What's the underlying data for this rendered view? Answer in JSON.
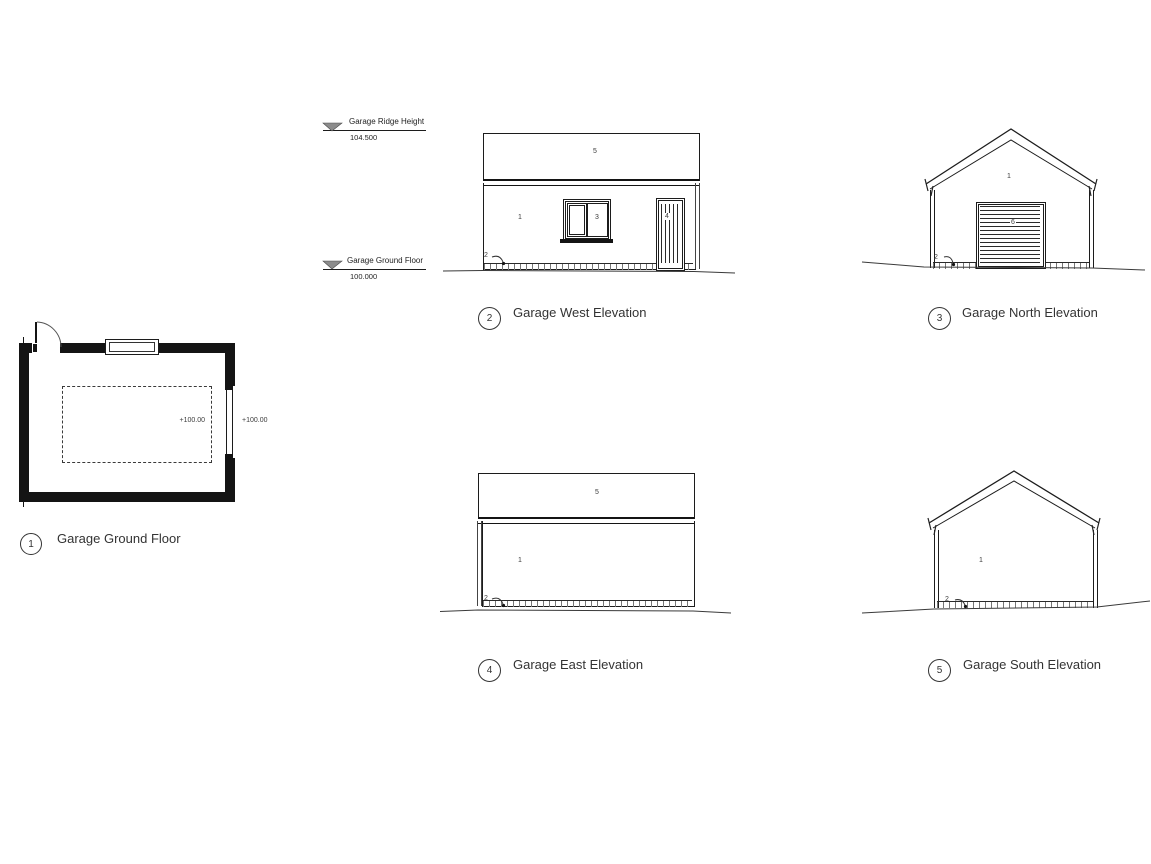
{
  "sheet": {
    "background": "#ffffff",
    "line_color": "#1c1c1c"
  },
  "levels": [
    {
      "label": "Garage Ridge Height",
      "value": "104.500"
    },
    {
      "label": "Garage Ground Floor",
      "value": "100.000"
    }
  ],
  "views": {
    "plan": {
      "number": "1",
      "title": "Garage Ground Floor",
      "level_inside": "+100.00",
      "level_outside": "+100.00"
    },
    "west": {
      "number": "2",
      "title": "Garage West Elevation",
      "tags": {
        "roof": "5",
        "wall": "1",
        "window": "3",
        "door": "4",
        "ground": "2"
      }
    },
    "north": {
      "number": "3",
      "title": "Garage North Elevation",
      "tags": {
        "wall": "1",
        "garage_door": "6",
        "ground": "2"
      }
    },
    "east": {
      "number": "4",
      "title": "Garage East Elevation",
      "tags": {
        "roof": "5",
        "wall": "1",
        "ground": "2"
      }
    },
    "south": {
      "number": "5",
      "title": "Garage South Elevation",
      "tags": {
        "wall": "1",
        "ground": "2"
      }
    }
  }
}
